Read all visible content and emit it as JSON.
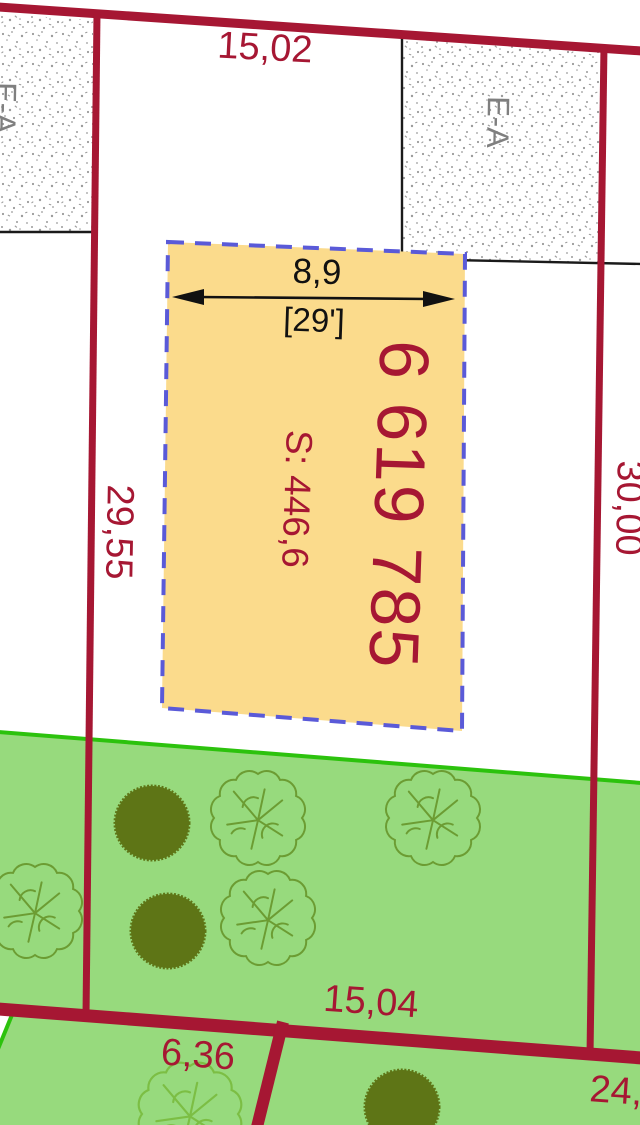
{
  "parcel": {
    "number": "6 619 785",
    "area_label": "S: 446,6"
  },
  "dimensions": {
    "top": "15,02",
    "left": "29,55",
    "right": "30,00",
    "width": "8,9",
    "width_feet": "[29']",
    "bottom": "15,04",
    "bottom_left": "6,36",
    "bottom_right_partial": "24,"
  },
  "zones": {
    "left": "E-A",
    "right": "E-A"
  },
  "colors": {
    "boundary_red": "#A61733",
    "parcel_fill": "#FBDB8C",
    "parcel_border_blue": "#5A5AD8",
    "vegetation_fill": "#97DA7D",
    "vegetation_border": "#2CC20D",
    "tree_solid": "#5E7516",
    "bush_outline": "#6C9C33",
    "bush_outline_light": "#7CBE44",
    "zone_text_gray": "#7F7F7F",
    "survey_black": "#1A1A1A"
  }
}
